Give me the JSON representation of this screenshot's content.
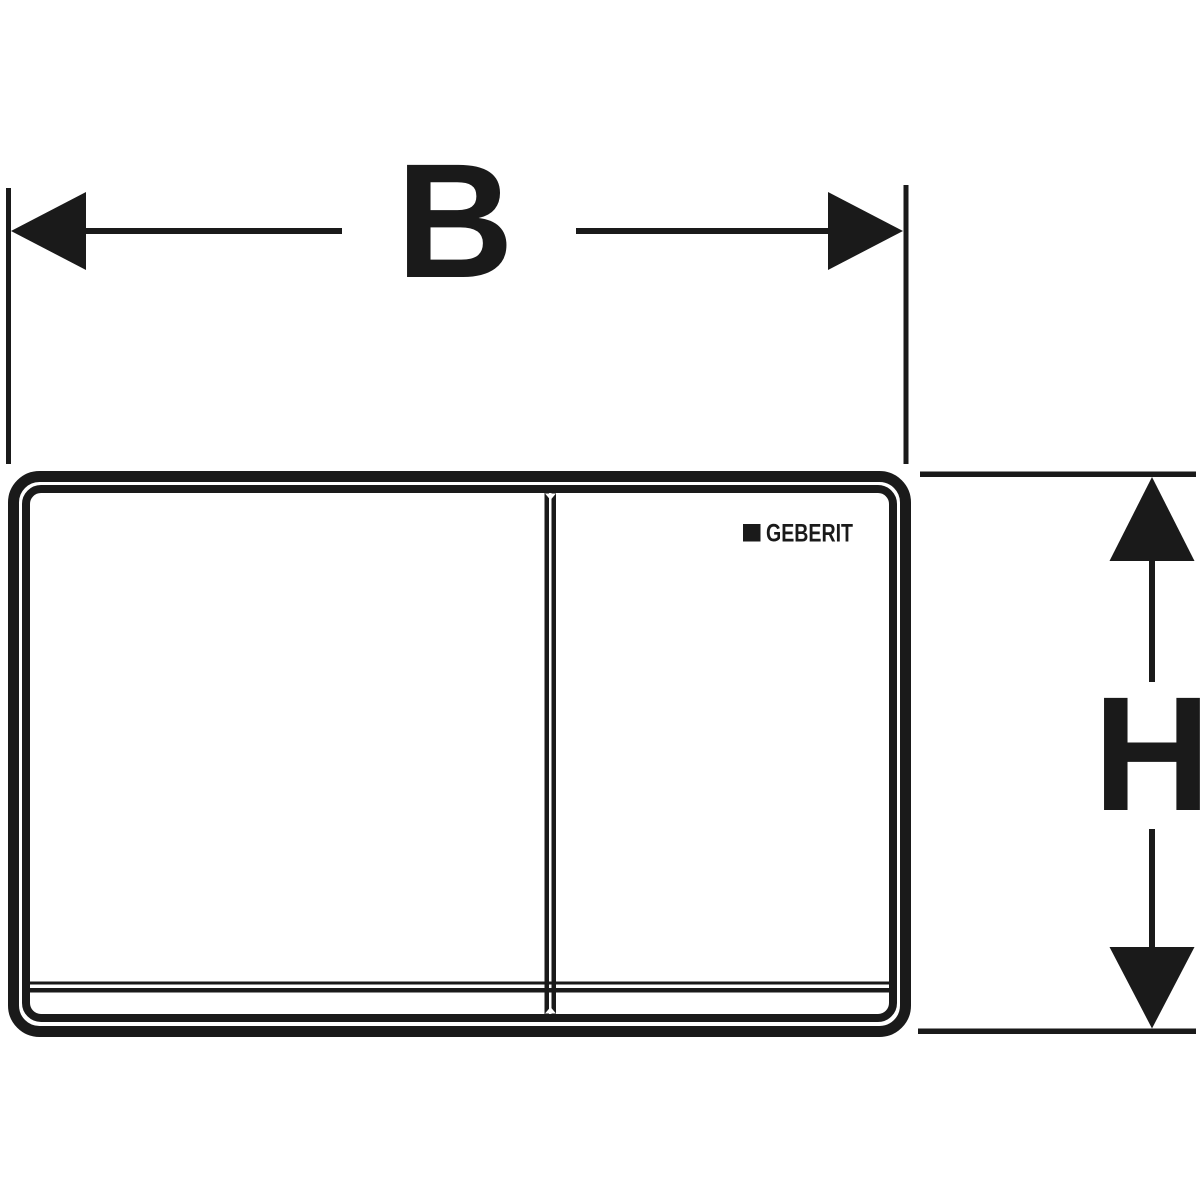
{
  "diagram": {
    "type": "technical-dimension-drawing",
    "dimension_labels": {
      "width": "B",
      "height": "H"
    },
    "logo": {
      "text": "GEBERIT"
    },
    "colors": {
      "ink": "#1a1a1a",
      "background": "#ffffff"
    }
  }
}
